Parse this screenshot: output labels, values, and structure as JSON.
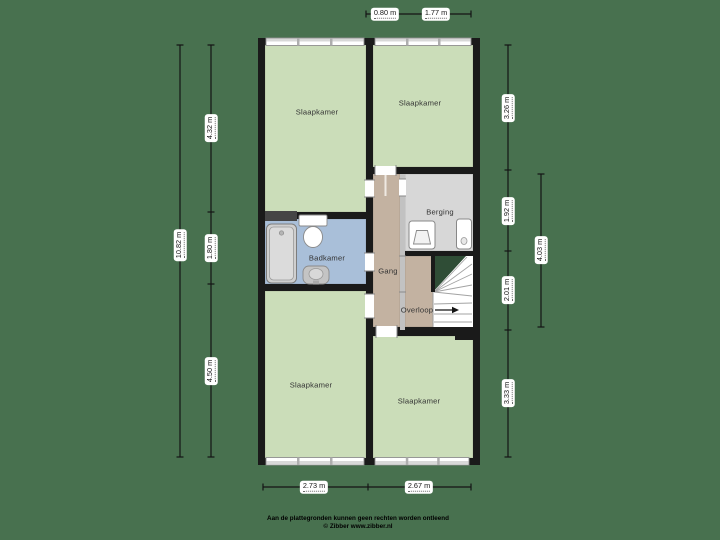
{
  "rooms": {
    "slaapkamer_tl": {
      "label": "Slaapkamer"
    },
    "slaapkamer_tr": {
      "label": "Slaapkamer"
    },
    "badkamer": {
      "label": "Badkamer"
    },
    "gang": {
      "label": "Gang"
    },
    "berging": {
      "label": "Berging"
    },
    "overloop": {
      "label": "Overloop"
    },
    "slaapkamer_bl": {
      "label": "Slaapkamer"
    },
    "slaapkamer_br": {
      "label": "Slaapkamer"
    }
  },
  "dimensions": {
    "top": [
      "0.80 m",
      "1.77 m"
    ],
    "bottom": [
      "2.73 m",
      "2.67 m"
    ],
    "left_outer": "10.82 m",
    "left_inner": [
      "4.32 m",
      "1.80 m",
      "4.50 m"
    ],
    "right_inner": [
      "3.26 m",
      "1.92 m",
      "2.01 m",
      "3.33 m"
    ],
    "right_outer": "4.03 m"
  },
  "footer": {
    "disclaimer": "Aan de plattegronden kunnen geen rechten worden ontleend",
    "credit": "© Zibber www.zibber.nl"
  },
  "colors": {
    "background": "#48714f",
    "room_green": "#cbddb9",
    "room_blue": "#a9bfd9",
    "room_tan": "#c3b2a1",
    "room_gray": "#d7d7d7",
    "wall": "#1a1a1a",
    "partition": "#c2c2c2",
    "stair_accent": "#2f4d36",
    "dim_line": "#141414"
  }
}
